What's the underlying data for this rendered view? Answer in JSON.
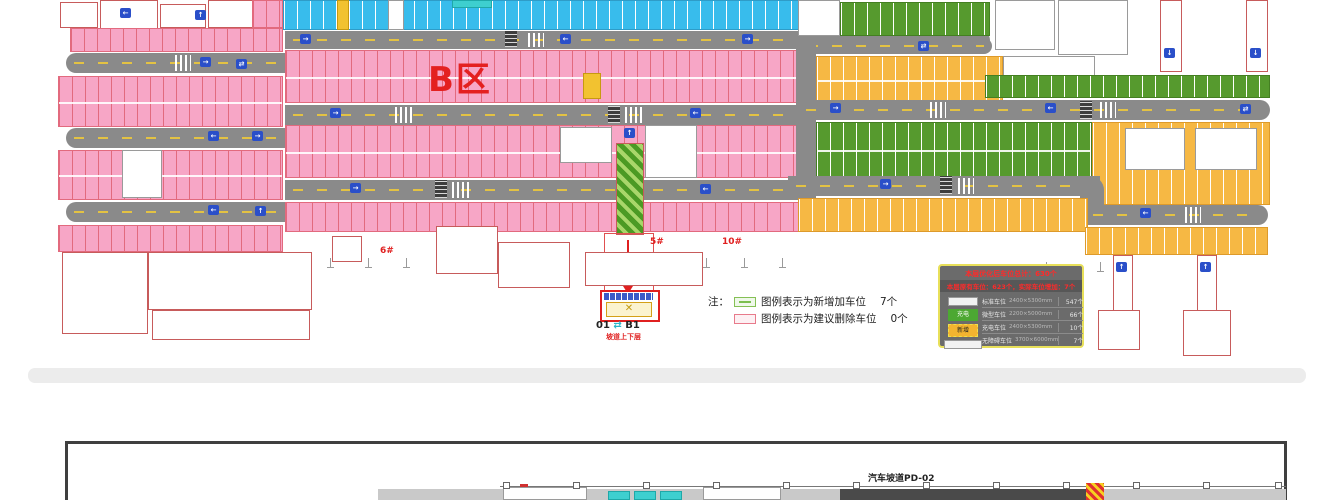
{
  "zone": {
    "label": "B区"
  },
  "icons": {
    "up": "↑",
    "down": "↓",
    "left": "←",
    "right": "→",
    "pair": "⇄",
    "cross": "✕"
  },
  "note": {
    "prefix": "注：",
    "items": [
      {
        "text": "图例表示为新增加车位",
        "count": "7个"
      },
      {
        "text": "图例表示为建议删除车位",
        "count": "0个"
      }
    ]
  },
  "legend": {
    "title": "本层优化后车位总计：630个",
    "subtitle": "本层原有车位：623个，实际车位增加：7个",
    "green_label": "充电",
    "yellow_label": "新增",
    "rows": [
      {
        "label": "标准车位",
        "dims": "2400×5300mm",
        "count": "547个"
      },
      {
        "label": "微型车位",
        "dims": "2200×5000mm",
        "count": "66个"
      },
      {
        "label": "充电车位",
        "dims": "2400×5300mm",
        "count": "10个"
      },
      {
        "label": "无障碍车位",
        "dims": "3700×6000mm",
        "count": "7个"
      }
    ]
  },
  "ramp": {
    "top": "01",
    "bottom": "B1",
    "caption": "坡道上下层"
  },
  "area_labels": [
    "6#",
    "10#",
    "5#",
    "10#"
  ],
  "lower": {
    "title": "汽车坡道PD-02"
  }
}
